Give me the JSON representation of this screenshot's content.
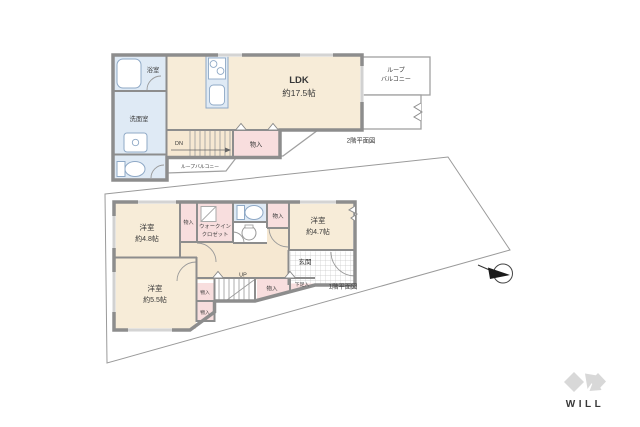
{
  "colors": {
    "room_beige": "#f7ecd8",
    "closet_pink": "#f8dede",
    "water_blue": "#dfeaf5",
    "wall_gray": "#8d8d8d",
    "boundary_gray": "#9a9a9a",
    "logo_gray": "#d8d8d8"
  },
  "floor2": {
    "plan_label": "2階平面図",
    "ldk": {
      "name": "LDK",
      "size": "約17.5帖"
    },
    "bath": {
      "name": "浴室"
    },
    "washroom": {
      "name": "洗面室"
    },
    "balcony_top": {
      "line1": "ループ",
      "line2": "バルコニー"
    },
    "balcony_side": {
      "name": "ループバルコニー"
    },
    "storage": {
      "name": "物入"
    },
    "stairs_label": "DN"
  },
  "floor1": {
    "plan_label": "1階平面図",
    "bedroom_a": {
      "name": "洋室",
      "size": "約4.8帖"
    },
    "bedroom_b": {
      "name": "洋室",
      "size": "約4.7帖"
    },
    "bedroom_c": {
      "name": "洋室",
      "size": "約5.5帖"
    },
    "wic": {
      "line1": "ウォークイン",
      "line2": "クロゼット"
    },
    "entrance": {
      "name": "玄関"
    },
    "shoe_box": {
      "name": "下足入"
    },
    "storage_a": {
      "name": "物入"
    },
    "storage_b": {
      "name": "物入"
    },
    "storage_c": {
      "name": "物入"
    },
    "storage_d": {
      "name": "物入"
    },
    "storage_e": {
      "name": "物入"
    },
    "stairs_label": "UP"
  },
  "logo": {
    "text": "WILL"
  }
}
